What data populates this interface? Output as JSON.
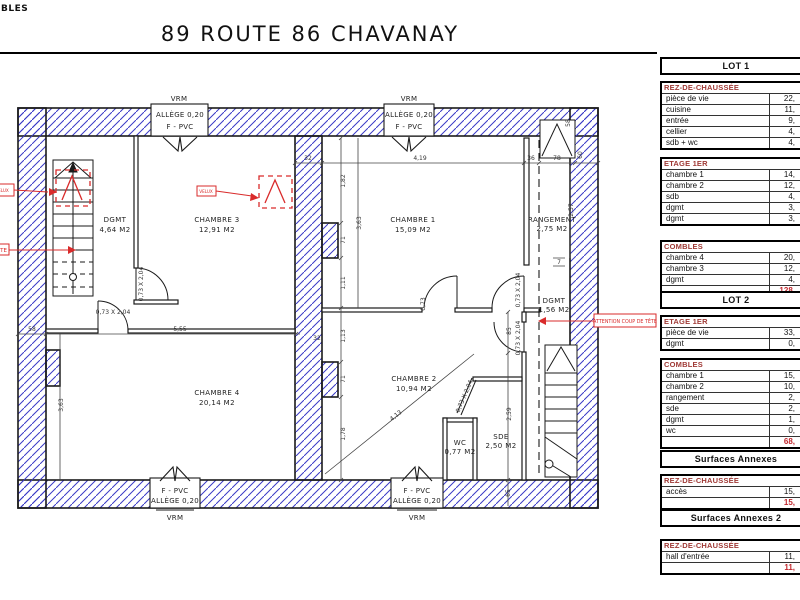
{
  "page": {
    "corner_label": "BLES",
    "title": "89 ROUTE 86 CHAVANAY"
  },
  "plan": {
    "rooms": [
      {
        "name": "DGMT",
        "area": "4,64 M2"
      },
      {
        "name": "CHAMBRE 3",
        "area": "12,91 M2"
      },
      {
        "name": "CHAMBRE 1",
        "area": "15,09 M2"
      },
      {
        "name": "RANGEMENT",
        "area": "2,75 M2"
      },
      {
        "name": "CHAMBRE 4",
        "area": "20,14 M2"
      },
      {
        "name": "CHAMBRE 2",
        "area": "10,94 M2"
      },
      {
        "name": "WC",
        "area": "0,77 M2"
      },
      {
        "name": "SDE",
        "area": "2,50 M2"
      },
      {
        "name": "DGMT",
        "area": "1,56 M2"
      }
    ],
    "window_labels": {
      "vrm": "VRM",
      "allege": "ALLÈGE 0,20",
      "frame": "F - PVC"
    },
    "dims": [
      "32",
      "4,19",
      "36",
      "78",
      "58",
      "5,55",
      "1,82",
      "71",
      "1,11",
      "1,13",
      "71",
      "1,78",
      "3,63",
      "3,63",
      "2,57",
      "7",
      "85",
      "2,59",
      "65",
      "58",
      "60",
      "32",
      "4,13",
      "0,73 X 2,04",
      "0,73 X 2,04",
      "0,73 X 2,04",
      "0,73 X 2,04",
      "0,73 X 2,04",
      "0,73"
    ],
    "annotations": {
      "attention": "ATTENTION COUP DE TÊTE",
      "tete": "TÊTE",
      "velux_left": "VELUX",
      "velux_ch3": "VELUX"
    },
    "colors": {
      "hatch": "#3a3ac6",
      "red": "#d92b2b",
      "wall": "#1a1a1a"
    }
  },
  "tables": {
    "lot1": {
      "title": "LOT 1",
      "sections": [
        {
          "header": "REZ-DE-CHAUSSÉE",
          "rows": [
            [
              "pièce de vie",
              "22,"
            ],
            [
              "cuisine",
              "11,"
            ],
            [
              "entrée",
              "9,"
            ],
            [
              "cellier",
              "4,"
            ],
            [
              "sdb + wc",
              "4,"
            ]
          ]
        },
        {
          "header": "ETAGE 1ER",
          "rows": [
            [
              "chambre 1",
              "14,"
            ],
            [
              "chambre 2",
              "12,"
            ],
            [
              "sdb",
              "4,"
            ],
            [
              "dgmt",
              "3,"
            ],
            [
              "dgmt",
              "3,"
            ]
          ]
        },
        {
          "header": "COMBLES",
          "rows": [
            [
              "chambre 4",
              "20,"
            ],
            [
              "chambre 3",
              "12,"
            ],
            [
              "dgmt",
              "4,"
            ]
          ]
        }
      ],
      "total": "128,"
    },
    "lot2": {
      "title": "LOT 2",
      "sections": [
        {
          "header": "ETAGE 1ER",
          "rows": [
            [
              "pièce de vie",
              "33,"
            ],
            [
              "dgmt",
              "0,"
            ]
          ]
        },
        {
          "header": "COMBLES",
          "rows": [
            [
              "chambre 1",
              "15,"
            ],
            [
              "chambre 2",
              "10,"
            ],
            [
              "rangement",
              "2,"
            ],
            [
              "sde",
              "2,"
            ],
            [
              "dgmt",
              "1,"
            ],
            [
              "wc",
              "0,"
            ]
          ]
        }
      ],
      "total": "68,"
    },
    "sa": {
      "title": "Surfaces Annexes",
      "sections": [
        {
          "header": "REZ-DE-CHAUSSÉE",
          "rows": [
            [
              "accès",
              "15,"
            ]
          ]
        }
      ],
      "total": "15,"
    },
    "sa2": {
      "title": "Surfaces Annexes 2",
      "sections": [
        {
          "header": "REZ-DE-CHAUSSÉE",
          "rows": [
            [
              "hall d'entrée",
              "11,"
            ]
          ]
        }
      ],
      "total": "11,"
    }
  }
}
